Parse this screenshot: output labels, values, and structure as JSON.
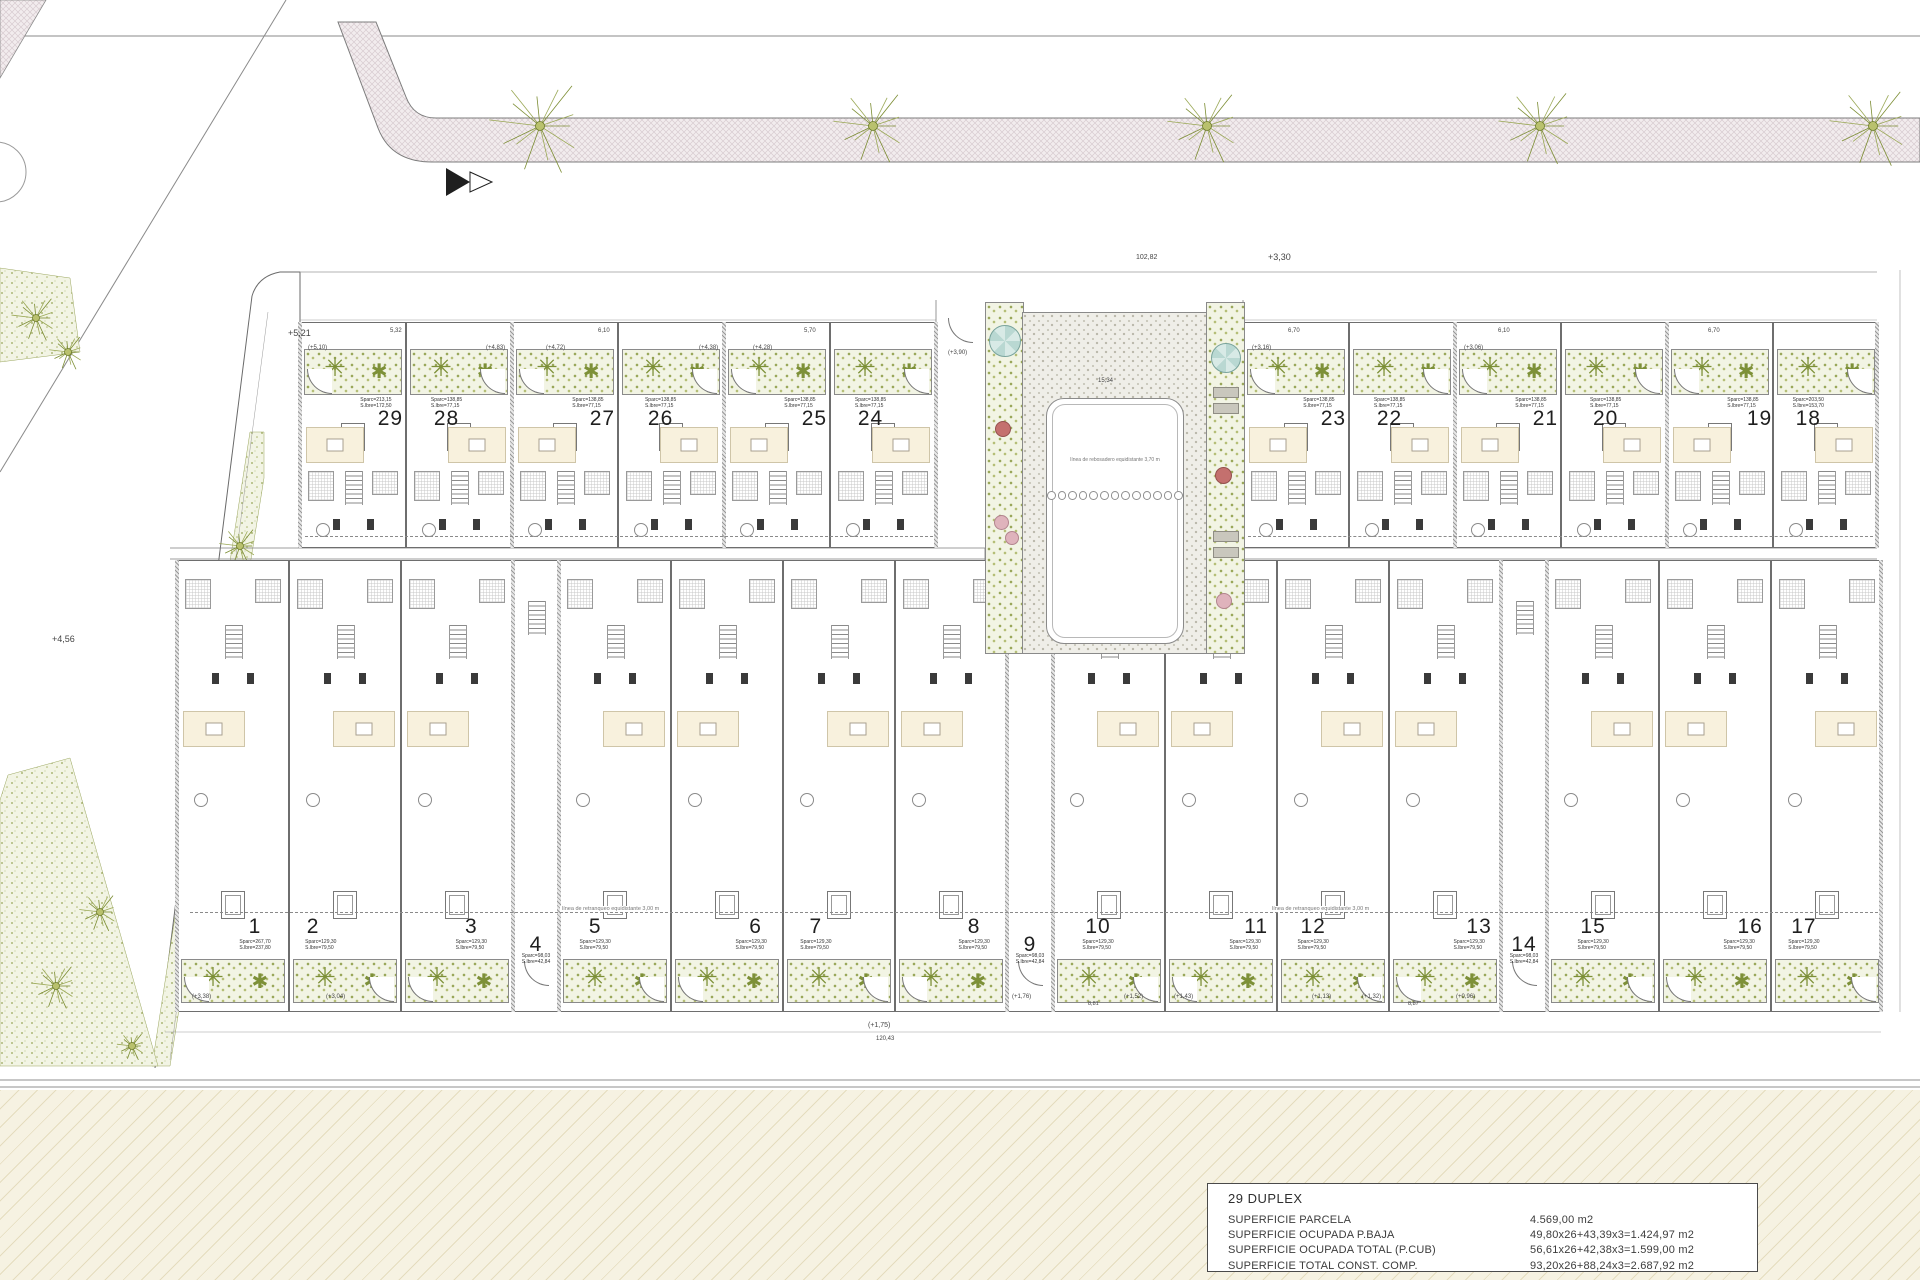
{
  "title_block": {
    "title": "29 DUPLEX",
    "rows": [
      {
        "label": "SUPERFICIE PARCELA",
        "value": "4.569,00 m2"
      },
      {
        "label": "SUPERFICIE OCUPADA P.BAJA",
        "value": "49,80x26+43,39x3=1.424,97 m2"
      },
      {
        "label": "SUPERFICIE OCUPADA TOTAL (P.CUB)",
        "value": "56,61x26+42,38x3=1.599,00 m2"
      },
      {
        "label": "SUPERFICIE TOTAL CONST. COMP.",
        "value": "93,20x26+88,24x3=2.687,92 m2"
      }
    ]
  },
  "pool": {
    "lane_text": "línea de rebosadero equidistante 3,70 m",
    "lane_circles": 13
  },
  "notes": {
    "retranqueo": "línea de retranqueo equidistante 3,00 m"
  },
  "plant_glyph": "✳",
  "colors": {
    "plan_line": "#555555",
    "garden_dot": "#97a557",
    "street_fill": "#f2ecee",
    "cream_band": "#f6f2e2",
    "pool_teal": "#b9d8d2",
    "flower_pink": "#dfb3bc",
    "flower_red": "#c4706e",
    "palm_olive": "#7c8d33"
  },
  "upper_left_units": [
    {
      "n": "29",
      "x": 300,
      "w": 106,
      "f": 0.86,
      "a1": "Sparc=213,15",
      "a2": "S.lbre=172,50"
    },
    {
      "n": "28",
      "x": 406,
      "w": 106,
      "f": 0.38,
      "a1": "Sparc=138,85",
      "a2": "S.lbre=77,15"
    },
    {
      "n": "27",
      "x": 512,
      "w": 106,
      "f": 0.86,
      "a1": "Sparc=138,85",
      "a2": "S.lbre=77,15"
    },
    {
      "n": "26",
      "x": 618,
      "w": 106,
      "f": 0.4,
      "a1": "Sparc=138,85",
      "a2": "S.lbre=77,15"
    },
    {
      "n": "25",
      "x": 724,
      "w": 106,
      "f": 0.86,
      "a1": "Sparc=138,85",
      "a2": "S.lbre=77,15"
    },
    {
      "n": "24",
      "x": 830,
      "w": 106,
      "f": 0.38,
      "a1": "Sparc=138,85",
      "a2": "S.lbre=77,15"
    }
  ],
  "upper_right_units": [
    {
      "n": "23",
      "x": 1243,
      "w": 106,
      "f": 0.86,
      "a1": "Sparc=138,85",
      "a2": "S.lbre=77,15"
    },
    {
      "n": "22",
      "x": 1349,
      "w": 106,
      "f": 0.38,
      "a1": "Sparc=138,85",
      "a2": "S.lbre=77,15"
    },
    {
      "n": "21",
      "x": 1455,
      "w": 106,
      "f": 0.86,
      "a1": "Sparc=138,85",
      "a2": "S.lbre=77,15"
    },
    {
      "n": "20",
      "x": 1561,
      "w": 106,
      "f": 0.42,
      "a1": "Sparc=138,85",
      "a2": "S.lbre=77,15"
    },
    {
      "n": "19",
      "x": 1667,
      "w": 106,
      "f": 0.88,
      "a1": "Sparc=138,85",
      "a2": "S.lbre=77,15"
    },
    {
      "n": "18",
      "x": 1773,
      "w": 106,
      "f": 0.33,
      "a1": "Sparc=203,50",
      "a2": "S.lbre=153,70"
    }
  ],
  "lower_units": [
    {
      "n": "1",
      "x": 177,
      "w": 112,
      "f": 0.7,
      "a1": "Sparc=267,70",
      "a2": "S.lbre=237,80"
    },
    {
      "n": "2",
      "x": 289,
      "w": 112,
      "f": 0.21,
      "a1": "Sparc=129,30",
      "a2": "S.lbre=79,50"
    },
    {
      "n": "3",
      "x": 401,
      "w": 112,
      "f": 0.63,
      "a1": "Sparc=129,30",
      "a2": "S.lbre=79,50"
    },
    {
      "n": "4",
      "x": 513,
      "w": 46,
      "f": 0.5,
      "a1": "Sparc=98,03",
      "a2": "S.lbre=42,84",
      "nw": true
    },
    {
      "n": "5",
      "x": 559,
      "w": 112,
      "f": 0.32,
      "a1": "Sparc=129,30",
      "a2": "S.lbre=79,50"
    },
    {
      "n": "6",
      "x": 671,
      "w": 112,
      "f": 0.76,
      "a1": "Sparc=129,30",
      "a2": "S.lbre=79,50"
    },
    {
      "n": "7",
      "x": 783,
      "w": 112,
      "f": 0.29,
      "a1": "Sparc=129,30",
      "a2": "S.lbre=79,50"
    },
    {
      "n": "8",
      "x": 895,
      "w": 112,
      "f": 0.71,
      "a1": "Sparc=129,30",
      "a2": "S.lbre=79,50"
    },
    {
      "n": "9",
      "x": 1007,
      "w": 46,
      "f": 0.5,
      "a1": "Sparc=98,03",
      "a2": "S.lbre=42,84",
      "nw": true
    },
    {
      "n": "10",
      "x": 1053,
      "w": 112,
      "f": 0.4,
      "a1": "Sparc=129,30",
      "a2": "S.lbre=79,50"
    },
    {
      "n": "11",
      "x": 1165,
      "w": 112,
      "f": 0.82,
      "a1": "Sparc=129,30",
      "a2": "S.lbre=79,50"
    },
    {
      "n": "12",
      "x": 1277,
      "w": 112,
      "f": 0.32,
      "a1": "Sparc=129,30",
      "a2": "S.lbre=79,50"
    },
    {
      "n": "13",
      "x": 1389,
      "w": 112,
      "f": 0.81,
      "a1": "Sparc=129,30",
      "a2": "S.lbre=79,50"
    },
    {
      "n": "14",
      "x": 1501,
      "w": 46,
      "f": 0.5,
      "a1": "Sparc=98,03",
      "a2": "S.lbre=42,84",
      "nw": true
    },
    {
      "n": "15",
      "x": 1547,
      "w": 112,
      "f": 0.41,
      "a1": "Sparc=129,30",
      "a2": "S.lbre=79,50"
    },
    {
      "n": "16",
      "x": 1659,
      "w": 112,
      "f": 0.82,
      "a1": "Sparc=129,30",
      "a2": "S.lbre=79,50"
    },
    {
      "n": "17",
      "x": 1771,
      "w": 112,
      "f": 0.29,
      "a1": "Sparc=129,30",
      "a2": "S.lbre=79,50"
    }
  ],
  "thick_walls": {
    "upper": [
      300,
      512,
      724,
      936,
      1243,
      1455,
      1667,
      1877
    ],
    "lower": [
      177,
      513,
      559,
      1007,
      1053,
      1501,
      1547,
      1881
    ]
  },
  "street_trees": [
    {
      "x": 540,
      "y": 126,
      "r": 54
    },
    {
      "x": 873,
      "y": 126,
      "r": 42
    },
    {
      "x": 1207,
      "y": 126,
      "r": 42
    },
    {
      "x": 1540,
      "y": 126,
      "r": 44
    },
    {
      "x": 1873,
      "y": 126,
      "r": 46
    }
  ],
  "palms": [
    {
      "x": 36,
      "y": 318,
      "r": 26
    },
    {
      "x": 68,
      "y": 352,
      "r": 20
    },
    {
      "x": 240,
      "y": 546,
      "r": 22
    },
    {
      "x": 206,
      "y": 606,
      "r": 18
    },
    {
      "x": 100,
      "y": 912,
      "r": 22
    },
    {
      "x": 56,
      "y": 986,
      "r": 26
    },
    {
      "x": 262,
      "y": 948,
      "r": 18
    },
    {
      "x": 132,
      "y": 1046,
      "r": 16
    }
  ],
  "labels": [
    {
      "t": "+5,21",
      "x": 288,
      "y": 328,
      "s": 9
    },
    {
      "t": "+3,30",
      "x": 1268,
      "y": 252,
      "s": 9
    },
    {
      "t": "102,82",
      "x": 1136,
      "y": 254,
      "s": 7
    },
    {
      "t": "+4,56",
      "x": 52,
      "y": 634,
      "s": 9
    },
    {
      "t": "(+1,75)",
      "x": 868,
      "y": 1022,
      "s": 7
    },
    {
      "t": "120,43",
      "x": 876,
      "y": 1036,
      "s": 6
    },
    {
      "t": "15,34",
      "x": 1098,
      "y": 378,
      "s": 6
    },
    {
      "t": "(+3,90)",
      "x": 948,
      "y": 350,
      "s": 6
    },
    {
      "t": "5,32",
      "x": 390,
      "y": 328,
      "s": 6
    },
    {
      "t": "6,10",
      "x": 598,
      "y": 328,
      "s": 6
    },
    {
      "t": "5,70",
      "x": 804,
      "y": 328,
      "s": 6
    },
    {
      "t": "6,70",
      "x": 1288,
      "y": 328,
      "s": 6
    },
    {
      "t": "6,10",
      "x": 1498,
      "y": 328,
      "s": 6
    },
    {
      "t": "6,70",
      "x": 1708,
      "y": 328,
      "s": 6
    },
    {
      "t": "(+5,10)",
      "x": 308,
      "y": 345,
      "s": 6
    },
    {
      "t": "(+4,83)",
      "x": 486,
      "y": 345,
      "s": 6
    },
    {
      "t": "(+4,72)",
      "x": 546,
      "y": 345,
      "s": 6
    },
    {
      "t": "(+4,38)",
      "x": 699,
      "y": 345,
      "s": 6
    },
    {
      "t": "(+4,28)",
      "x": 753,
      "y": 345,
      "s": 6
    },
    {
      "t": "(+3,16)",
      "x": 1252,
      "y": 345,
      "s": 6
    },
    {
      "t": "(+3,06)",
      "x": 1464,
      "y": 345,
      "s": 6
    },
    {
      "t": "(+3,38)",
      "x": 192,
      "y": 994,
      "s": 6
    },
    {
      "t": "(+3,04)",
      "x": 326,
      "y": 994,
      "s": 6
    },
    {
      "t": "(+1,76)",
      "x": 1012,
      "y": 994,
      "s": 6
    },
    {
      "t": "(+1,52)",
      "x": 1124,
      "y": 994,
      "s": 6
    },
    {
      "t": "(+1,43)",
      "x": 1174,
      "y": 994,
      "s": 6
    },
    {
      "t": "(+1,13)",
      "x": 1312,
      "y": 994,
      "s": 6
    },
    {
      "t": "(+1,32)",
      "x": 1362,
      "y": 994,
      "s": 6
    },
    {
      "t": "(+0,96)",
      "x": 1456,
      "y": 994,
      "s": 6
    },
    {
      "t": "8,81",
      "x": 1088,
      "y": 1001,
      "s": 5.5
    },
    {
      "t": "8,87",
      "x": 1408,
      "y": 1001,
      "s": 5.5
    }
  ]
}
